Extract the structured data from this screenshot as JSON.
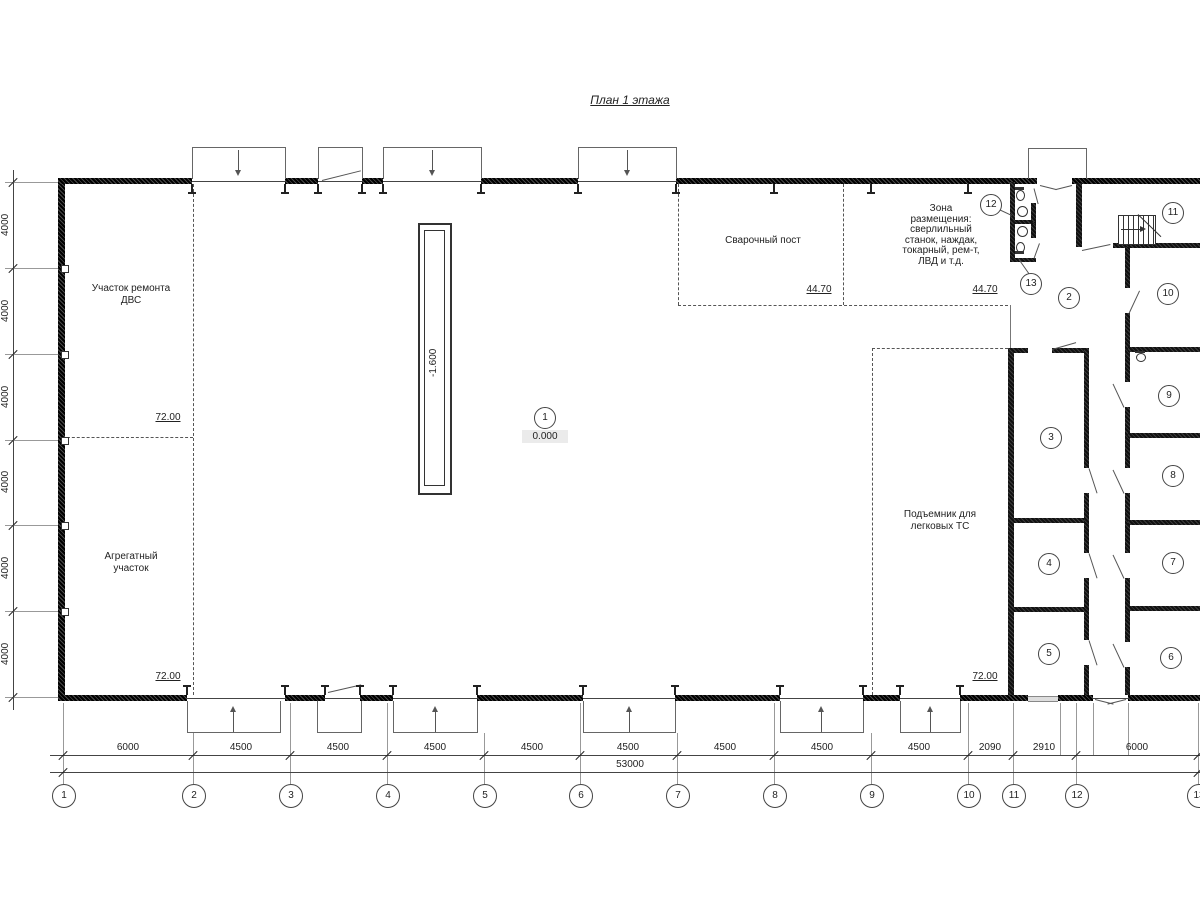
{
  "title": "План 1 этажа",
  "labels": {
    "repair": [
      "Участок ремонта",
      "ДВС"
    ],
    "aggregate": [
      "Агрегатный",
      "участок"
    ],
    "welding": "Сварочный пост",
    "zone": [
      "Зона",
      "размещения:",
      "сверлильный",
      "станок, наждак,",
      "токарный, рем-т,",
      "ЛВД и т.д."
    ],
    "lift": [
      "Подъемник для",
      "легковых ТС"
    ]
  },
  "areas": {
    "repair": "72.00",
    "aggregate": "72.00",
    "welding": "44.70",
    "zone": "44.70",
    "lift": "72.00"
  },
  "levels": {
    "pit": "-1.600",
    "floor": "0.000"
  },
  "room_bubbles": [
    "1",
    "2",
    "3",
    "4",
    "5",
    "6",
    "7",
    "8",
    "9",
    "10",
    "11",
    "12",
    "13"
  ],
  "axes": {
    "numbers": [
      "1",
      "2",
      "3",
      "4",
      "5",
      "6",
      "7",
      "8",
      "9",
      "10",
      "11",
      "12",
      "13"
    ],
    "spans": [
      "6000",
      "4500",
      "4500",
      "4500",
      "4500",
      "4500",
      "4500",
      "4500",
      "4500",
      "2090",
      "2910",
      "6000"
    ],
    "total": "53000",
    "left_spans": [
      "4000",
      "4000",
      "4000",
      "4000",
      "4000",
      "4000"
    ]
  }
}
